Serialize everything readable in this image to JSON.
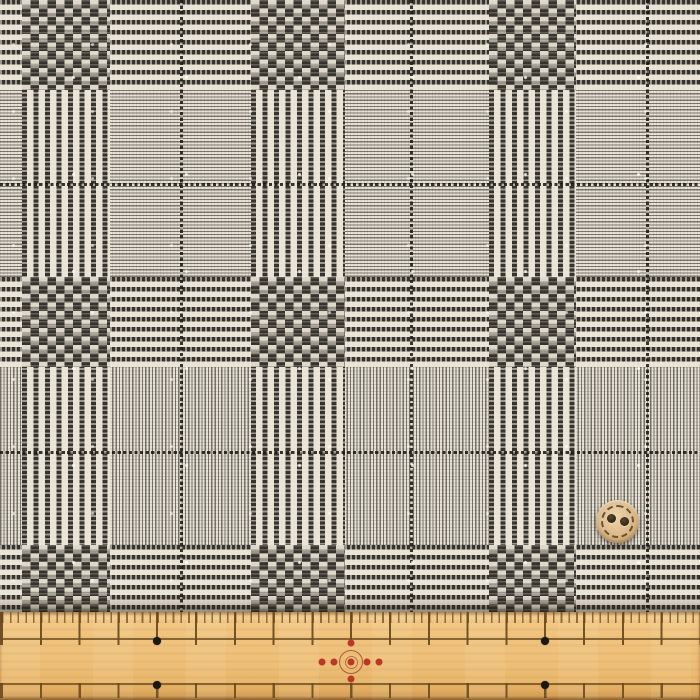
{
  "figure": {
    "description": "Photograph of a black-and-white glen check (Prince of Wales check) woven fabric swatch laid flat, with a tan wooden ruler lying across the bottom edge and a small two-hole wooden button placed on the fabric for scale",
    "pattern_name": "glen check",
    "fabric_description": "Alternating houndstooth blocks, dashed stripe bands and plain woven grey blocks crossed by fine black overcheck lines",
    "objects": [
      "fabric swatch",
      "wooden ruler",
      "two-hole wooden button"
    ]
  },
  "ruler": {
    "description": "Tan wooden ruler with fine ticks along the top edge, long interval ticks, a plain middle zone, and spaced ticks along the bottom edge",
    "black_dot_markers": 4,
    "center_mark": "red compass-rose of dots with two concentric rings at the ruler centre",
    "printed_text": ""
  },
  "button": {
    "description": "Round light wooden button with two holes and a dashed stitch ring near the rim",
    "holes": 2
  },
  "palette": {
    "fabric_cream": "#e9e3d6",
    "fabric_dark": "#36332c",
    "wood_light": "#f6d092",
    "wood_mid": "#eec07a",
    "wood_deep": "#c18a4c",
    "tick_brown": "#6e4e20",
    "marker_black": "#1b1712",
    "marker_red": "#bb3828",
    "button_wood": "#e0bd8f",
    "button_hole": "#2e2417",
    "button_stitch": "#54412a"
  }
}
